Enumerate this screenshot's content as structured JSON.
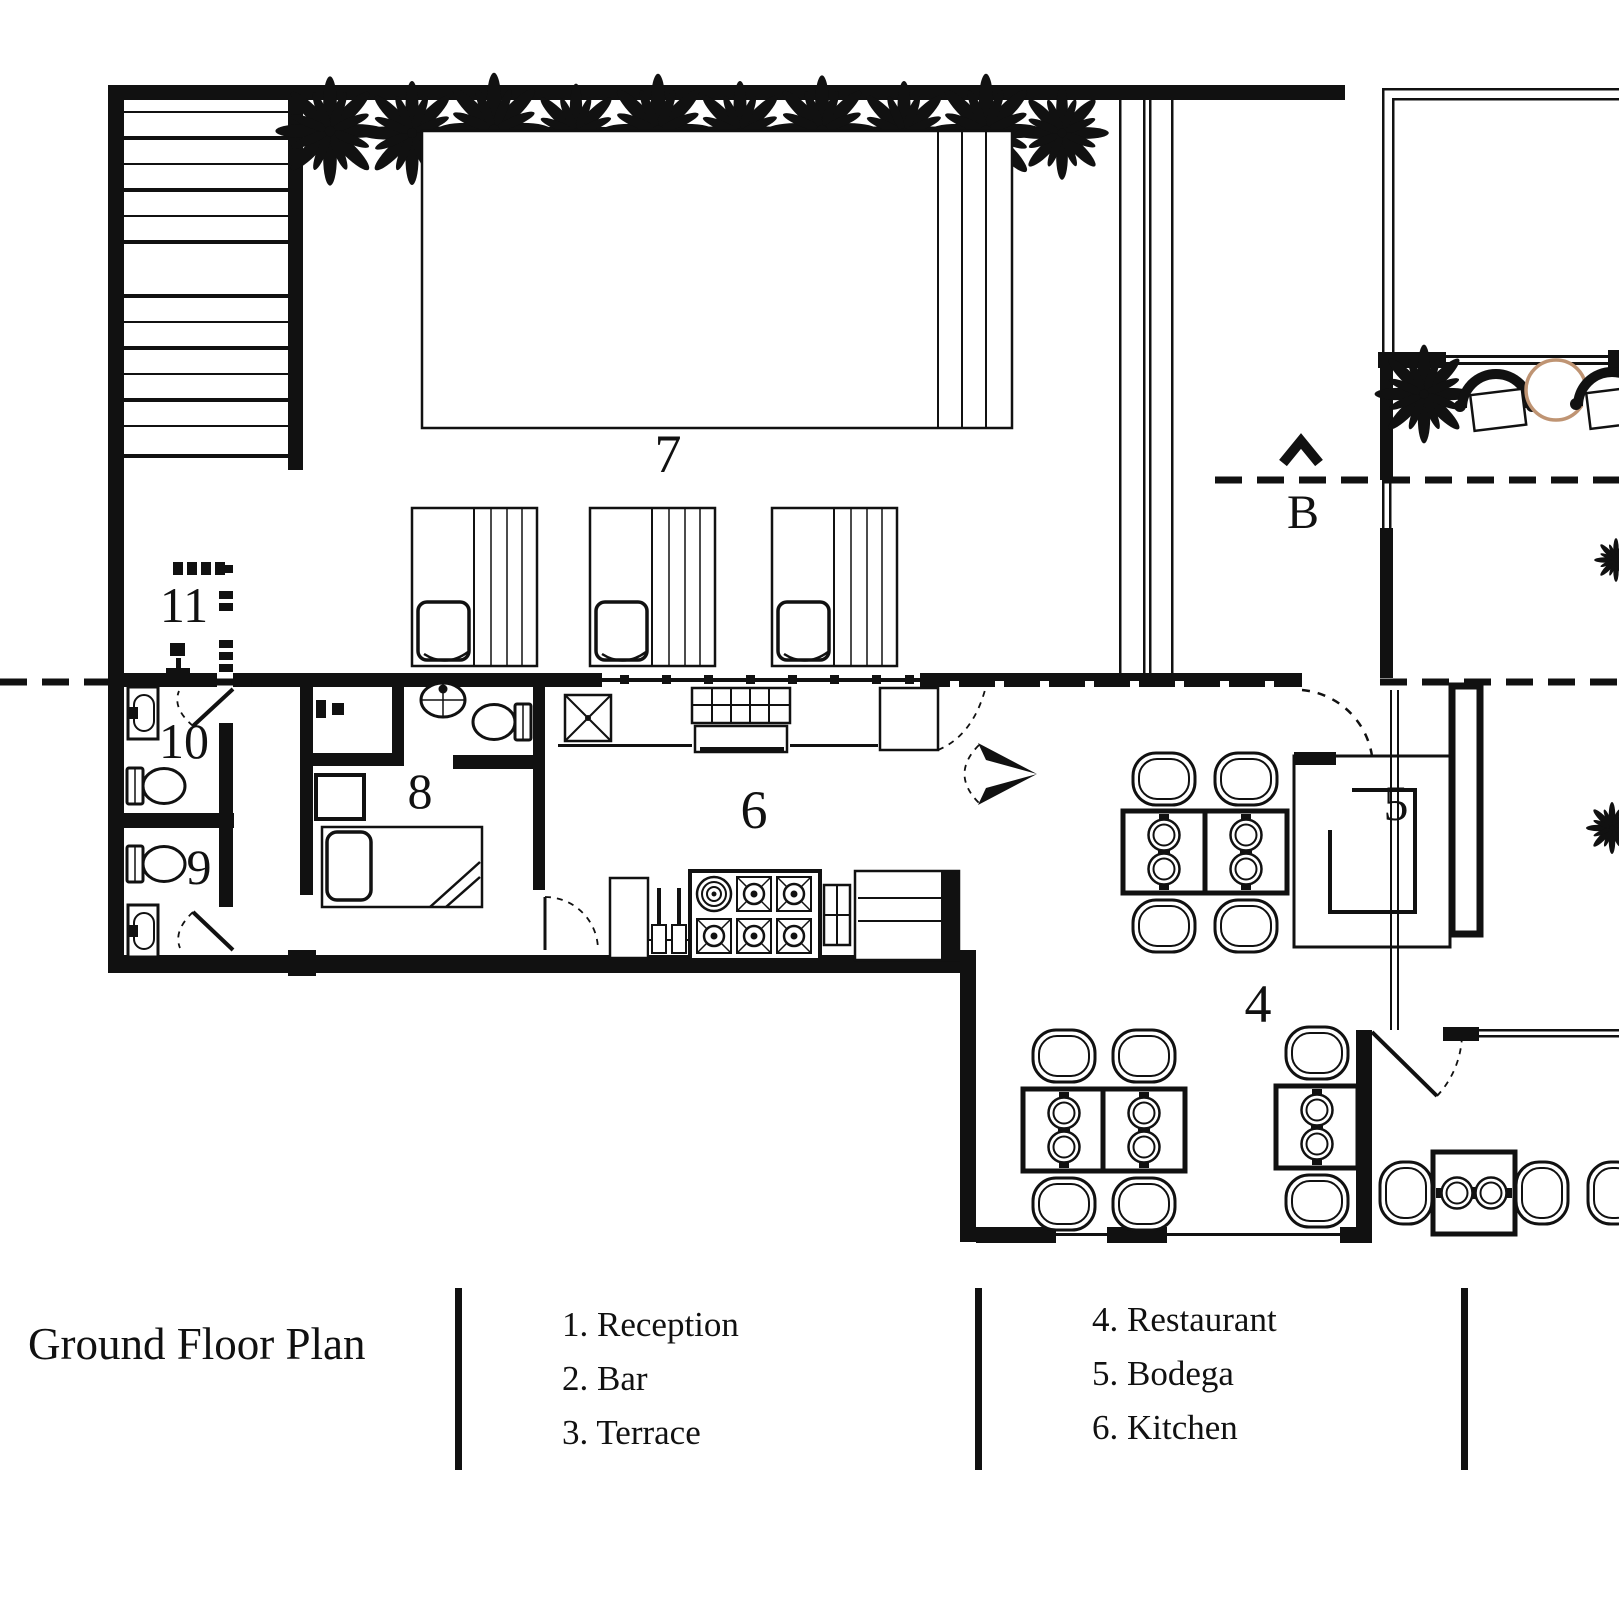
{
  "title": "Ground Floor Plan",
  "legend": {
    "columns": [
      {
        "items": [
          "1. Reception",
          "2. Bar",
          "3. Terrace"
        ]
      },
      {
        "items": [
          "4. Restaurant",
          "5. Bodega",
          "6. Kitchen"
        ]
      }
    ]
  },
  "plan": {
    "labels": {
      "n4": "4",
      "n5": "5",
      "n6": "6",
      "n7": "7",
      "n8": "8",
      "n9": "9",
      "n10": "10",
      "n11": "11"
    },
    "section_marker": "B"
  },
  "rooms_named_in_legend": {
    "1": "Reception",
    "2": "Bar",
    "3": "Terrace",
    "4": "Restaurant",
    "5": "Bodega",
    "6": "Kitchen"
  },
  "icons": {
    "palm-tree-icon": "top-view palm/tree starburst",
    "fern-plant-icon": "top-view fern plant",
    "armchair-icon": "top-view lounge armchair",
    "round-table-icon": "round side table",
    "dining-chair-icon": "top-view dining chair",
    "dining-table-icon": "square table with two place settings",
    "toilet-icon": "top-view toilet with tank",
    "wall-sink-icon": "rectangular wall sink",
    "pedestal-sink-icon": "oval pedestal sink",
    "lounge-bed-icon": "daybed with deck slats",
    "bed-icon": "single bed with pillow",
    "stove-icon": "6-burner range",
    "oven-icon": "oven box",
    "prep-sink-icon": "square sink with X",
    "door-swing-icon": "door leaf with dashed swing arc",
    "section-arrow-icon": "section view chevron arrow",
    "stairs-icon": "staircase treads"
  },
  "colors": {
    "ink": "#111111",
    "background": "#ffffff",
    "round_table_accent": "#bf9473"
  }
}
